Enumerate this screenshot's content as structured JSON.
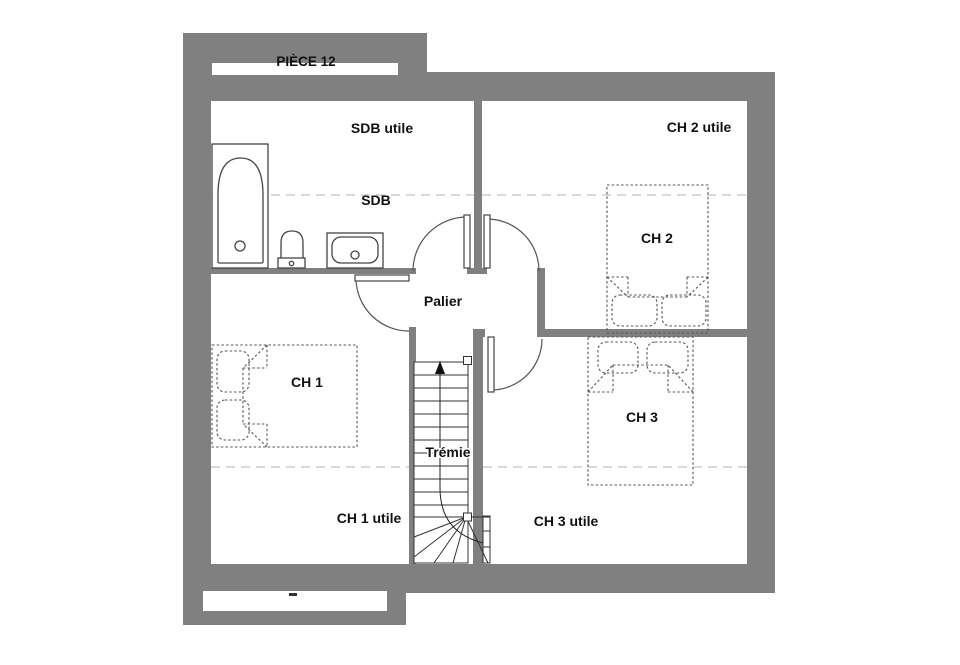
{
  "plan": {
    "title": "PIÈCE 12",
    "labels": {
      "piece_12": "PIÈCE 12",
      "sdb_utile": "SDB utile",
      "ch2_utile": "CH 2 utile",
      "sdb": "SDB",
      "ch2": "CH 2",
      "palier": "Palier",
      "ch1": "CH 1",
      "ch3": "CH 3",
      "tremie": "Trémie",
      "ch1_utile": "CH 1 utile",
      "ch3_utile": "CH 3 utile"
    },
    "colors": {
      "wall": "#808080",
      "line": "#444444",
      "bed_dash": "#555555",
      "utile_dash": "#cccccc",
      "text": "#111111",
      "background": "#ffffff"
    }
  }
}
